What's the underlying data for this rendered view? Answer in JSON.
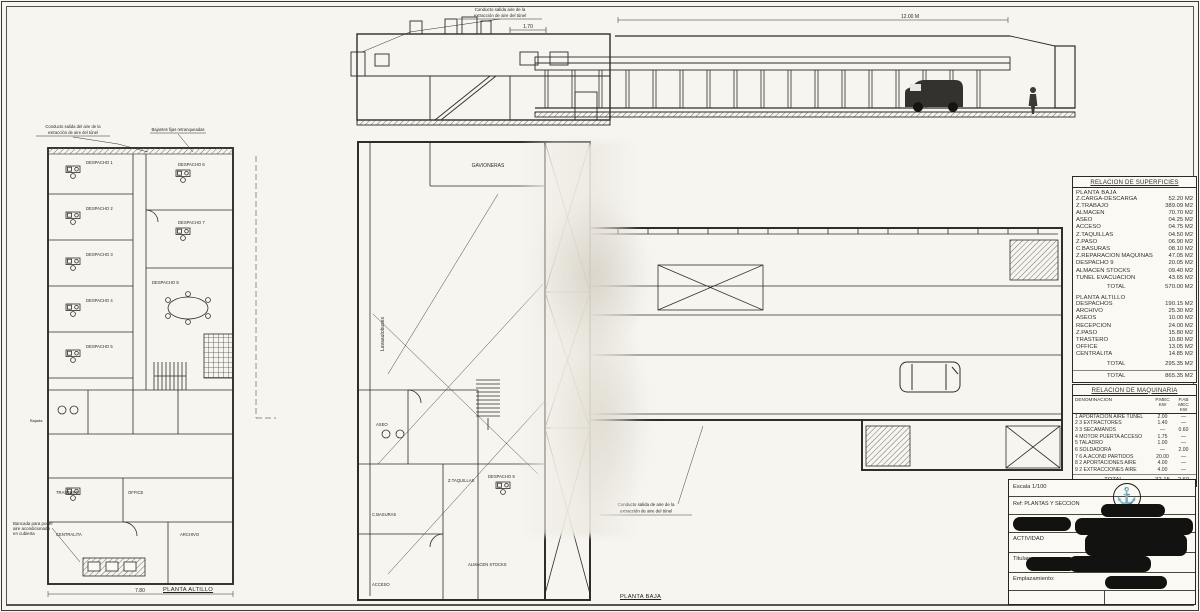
{
  "elevation": {
    "note_l1": "Conducto salida aire de la",
    "note_l2": "extracción de aire del túnel",
    "dim_height": "1.70",
    "dim_length": "12.00 M"
  },
  "left_plan": {
    "title": "PLANTA ALTILLO",
    "dim_width": "7.80",
    "label_bajada": "Bajada",
    "note_duct_l1": "Conducto salida del aire de la",
    "note_duct_l2": "extracción de aire del túnel",
    "note_bajantes": "Bajantes fijas retranqueadas",
    "note_bancada_l1": "Bancada para poner",
    "note_bancada_l2": "aire acondicionado",
    "note_bancada_l3": "en cubierta",
    "rooms": [
      "DESPACHO 1",
      "DESPACHO 2",
      "DESPACHO 3",
      "DESPACHO 4",
      "DESPACHO 5",
      "DESPACHO 6",
      "DESPACHO 7",
      "DESPACHO 8",
      "OFFICE",
      "TRASTERO",
      "CENTRALITA",
      "ARCHIVO"
    ]
  },
  "center_plan": {
    "title": "PLANTA BAJA",
    "label_gavioneras": "GAVIONERAS",
    "label_lava": "Lavaautobuses",
    "note_duct_l1": "Conducto salida de aire de la",
    "note_duct_l2": "extracción de aire del túnel",
    "rooms": [
      "ASEO",
      "Z.TAQUILLAS",
      "C.BASURAS",
      "ACCESO",
      "DESPACHO 9",
      "ALMACEN STOCKS"
    ]
  },
  "surfaces_table": {
    "title": "RELACION DE SUPERFICIES",
    "sections": [
      {
        "heading": "PLANTA BAJA",
        "rows": [
          [
            "Z.CARGA-DESCARGA",
            "52.20 M2"
          ],
          [
            "Z.TRABAJO",
            "389.09 M2"
          ],
          [
            "ALMACEN",
            "70.70 M2"
          ],
          [
            "ASEO",
            "04.25 M2"
          ],
          [
            "ACCESO",
            "04.75 M2"
          ],
          [
            "Z.TAQUILLAS",
            "04.50 M2"
          ],
          [
            "Z.PASO",
            "06.90 M2"
          ],
          [
            "C.BASURAS",
            "08.10 M2"
          ],
          [
            "Z.REPARACION MAQUINAS",
            "47.05 M2"
          ],
          [
            "DESPACHO 9",
            "20.05 M2"
          ],
          [
            "ALMACEN STOCKS",
            "09.40 M2"
          ],
          [
            "TUNEL EVACUACION",
            "43.65 M2"
          ]
        ],
        "total_label": "TOTAL",
        "total": "570.00 M2"
      },
      {
        "heading": "PLANTA ALTILLO",
        "rows": [
          [
            "DESPACHOS",
            "190.15 M2"
          ],
          [
            "ARCHIVO",
            "25.30 M2"
          ],
          [
            "ASEOS",
            "10.00 M2"
          ],
          [
            "RECEPCION",
            "24.00 M2"
          ],
          [
            "Z.PASO",
            "15.80 M2"
          ],
          [
            "TRASTERO",
            "10.80 M2"
          ],
          [
            "OFFICE",
            "13.05 M2"
          ],
          [
            "CENTRALITA",
            "14.85 M2"
          ]
        ],
        "total_label": "TOTAL",
        "total": "295.35 M2"
      }
    ],
    "grand_total_label": "TOTAL",
    "grand_total": "865.35 M2"
  },
  "machinery_table": {
    "title": "RELACION DE MAQUINARIA",
    "col_name": "DENOMINACION",
    "col1_l1": "P.MEC",
    "col1_l2": "KW",
    "col2_l1": "P.AB MEC",
    "col2_l2": "KW",
    "rows": [
      [
        "1 APORTACION AIRE TUNEL",
        "2.00",
        "—"
      ],
      [
        "2 3 EXTRACTORES",
        "1.40",
        "—"
      ],
      [
        "3 3 SECAMANOS",
        "—",
        "0.60"
      ],
      [
        "4 MOTOR PUERTA ACCESO",
        "1.75",
        "—"
      ],
      [
        "5 TALADRO",
        "1.00",
        "—"
      ],
      [
        "6 SOLDADORA",
        "—",
        "2.00"
      ],
      [
        "7 6 A.ACOND PARTIDOS",
        "20.00",
        "—"
      ],
      [
        "8 2 APORTACIONES AIRE",
        "4.00",
        "—"
      ],
      [
        "9 2 EXTRACCIONES AIRE",
        "4.00",
        "—"
      ]
    ],
    "total_label": "TOTAL",
    "total1": "32.15",
    "total2": "2.60"
  },
  "title_block": {
    "escala": "Escala 1/100",
    "ref": "Ref: PLANTAS Y SECCION",
    "actividad": "ACTIVIDAD",
    "titular": "Titular:",
    "emplazamiento": "Emplazamiento:"
  }
}
